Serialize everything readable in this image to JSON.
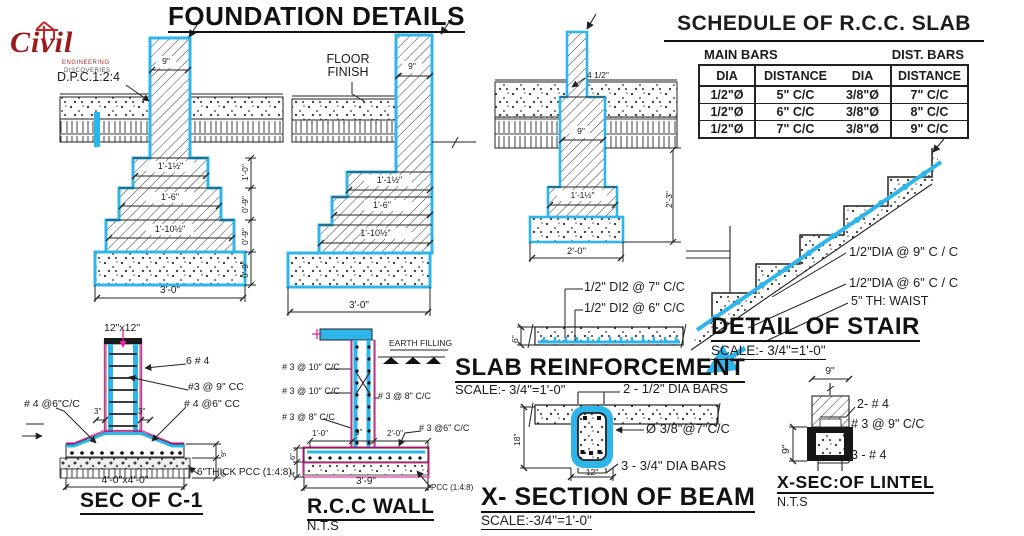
{
  "logo": {
    "brand": "Civil",
    "sub1": "ENGINEERING",
    "sub2": "DISCOVERIES"
  },
  "foundation_details": {
    "title": "FOUNDATION DETAILS",
    "dpc_label": "D.P.C.1:2:4",
    "floor_finish_1": "FLOOR",
    "floor_finish_2": "FINISH",
    "f1": {
      "wall_width": "9\"",
      "step1": "1'-1½\"",
      "step2": "1'-6\"",
      "step3": "1'-10½\"",
      "base_width": "3'-0\"",
      "vdim1": "1'-0\"",
      "vdim2": "0'-9\"",
      "vdim3": "0'-9\"",
      "vdim4": "0'-9\""
    },
    "f2": {
      "wall_width": "9\"",
      "step1": "1'-1½\"",
      "step2": "1'-6\"",
      "step3": "1'-10½\"",
      "base_width": "3'-0\""
    },
    "f3": {
      "wall_top_width": "4 1/2\"",
      "wall_width": "9\"",
      "step1": "1'-1½\"",
      "base_width": "2'-0\"",
      "depth": "2'-3\""
    }
  },
  "schedule": {
    "title": "SCHEDULE OF R.C.C. SLAB",
    "group_main": "MAIN BARS",
    "group_dist": "DIST. BARS",
    "columns": [
      "DIA",
      "DISTANCE",
      "DIA",
      "DISTANCE"
    ],
    "rows": [
      [
        "1/2\"Ø",
        "5\" C/C",
        "3/8\"Ø",
        "7\" C/C"
      ],
      [
        "1/2\"Ø",
        "6\" C/C",
        "3/8\"Ø",
        "8\" C/C"
      ],
      [
        "1/2\"Ø",
        "7\" C/C",
        "3/8\"Ø",
        "9\" C/C"
      ]
    ]
  },
  "stair": {
    "title": "DETAIL OF STAIR",
    "scale": "SCALE:- 3/4\"=1'-0\"",
    "label_main_bars": "1/2\"DIA @ 9\" C / C",
    "label_dist_bars": "1/2\"DIA @ 6\" C / C",
    "label_waist": "5\" TH: WAIST"
  },
  "slab": {
    "title": "SLAB  REINFORCEMENT",
    "scale": "SCALE:- 3/4\"=1'-0\"",
    "label_top": "1/2\" DI2 @  7\" C/C",
    "label_bottom": "1/2\" DI2 @  6\" C/C",
    "thickness": "6\""
  },
  "beam": {
    "title": "X- SECTION  OF BEAM",
    "scale": "SCALE:-3/4\"=1'-0\"",
    "top_bars": "2 - 1/2\" DIA BARS",
    "stirrups": "Ø 3/8\"@7\"C/C",
    "bottom_bars": "3 - 3/4\" DIA  BARS",
    "depth": "18\"",
    "width": "12\""
  },
  "lintel": {
    "title": "X-SEC:OF LINTEL",
    "scale": "N.T.S",
    "top_width": "9\"",
    "height": "9\"",
    "top_bars": "2- # 4",
    "stirrups": "# 3 @ 9\" C/C",
    "bottom_bars": "3 - # 4"
  },
  "sec_c1": {
    "title": "SEC OF C-1",
    "column_size": "12\"x12\"",
    "vertical_bars": "6 # 4",
    "ties": "#3 @ 9\" CC",
    "left_bars": "# 4 @6\"C/C",
    "right_bars": "# 4 @6\" CC",
    "offset_left": "3\"",
    "offset_right": "3\"",
    "footing_size": "4'-0\"x4'-0\"",
    "pcc_note": "6\"THICK PCC (1:4:8)",
    "footing_depth": "9\"",
    "pcc_depth": "6\""
  },
  "rcc_wall": {
    "title": "R.C.C WALL",
    "scale": "N.T.S",
    "earth": "EARTH FILLING",
    "left_label_1": "# 3 @ 10\" C/C",
    "left_label_2": "# 3 @ 10\" C/C",
    "left_label_3": "# 3 @ 8\" C/C",
    "right_label_1": "# 3 @ 8\" C/C",
    "right_label_2": "# 3 @6\" C/C",
    "toe_left": "1'-0\"",
    "wall_width": "9\"",
    "toe_right": "2'-0\"",
    "slab_depth": "6\"",
    "pcc_depth": "4\"",
    "base_width": "3'-9\"",
    "pcc_note": "PCC (1:4:8)"
  },
  "colors": {
    "cyan": "#2eb5e9",
    "magenta": "#e8209e",
    "line": "#1e1e1e",
    "logo_red": "#9b1b1b"
  }
}
